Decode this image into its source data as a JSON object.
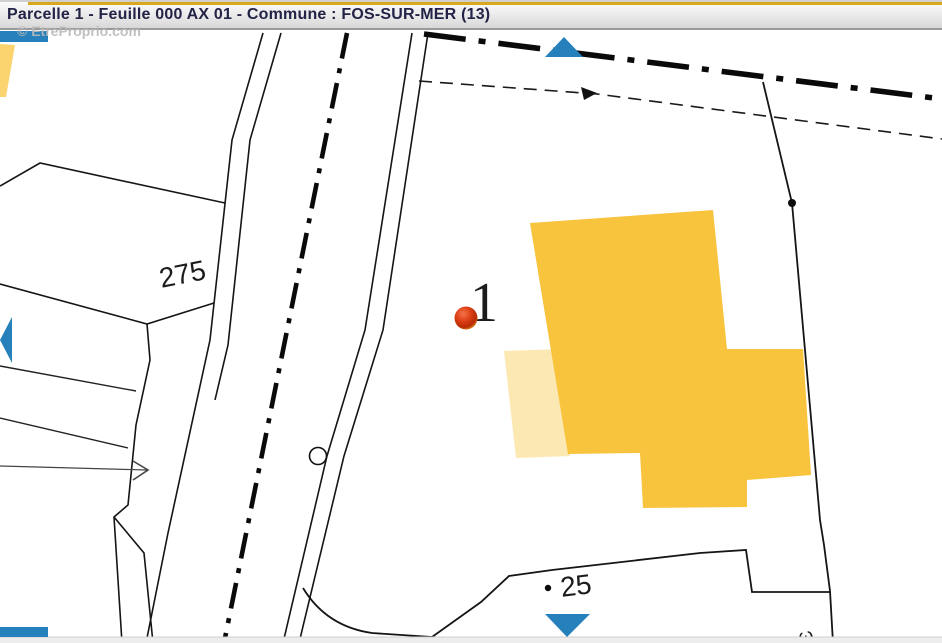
{
  "title_bar": {
    "title": "Parcelle 1 - Feuille 000 AX 01 - Commune : FOS-SUR-MER (13)"
  },
  "watermark": {
    "text": "© EtreProprio.com"
  },
  "map": {
    "labels": {
      "parcel_left": "275",
      "parcel_main": "1",
      "parcel_bottom": "25",
      "partial_bottom": "ω"
    }
  },
  "colors": {
    "accent_blue": "#2580BC",
    "building_yellow": "#F8C33D",
    "building_pale_yellow": "#FCE8B2",
    "wedge_yellow": "#FBD470",
    "marker_center": "#F4744A",
    "marker_mid": "#DC3E14",
    "marker_dark": "#B72B04",
    "marker_rim": "#E89020",
    "title_text": "#232347"
  }
}
